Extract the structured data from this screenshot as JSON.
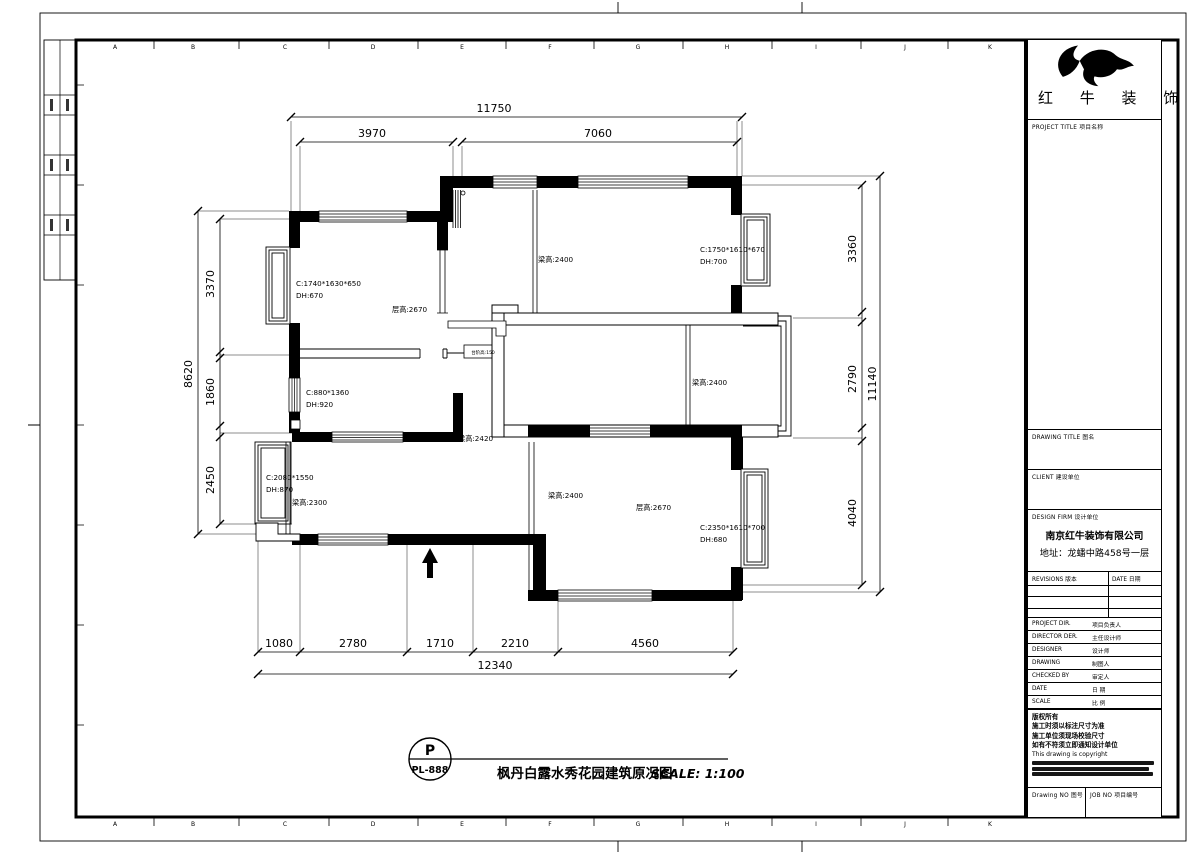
{
  "sheet": {
    "grid_letters": [
      "A",
      "B",
      "C",
      "D",
      "E",
      "F",
      "G",
      "H",
      "I",
      "J",
      "K"
    ],
    "grid_x": [
      115,
      193,
      285,
      373,
      462,
      550,
      638,
      727,
      816,
      905,
      990
    ],
    "accent_color": "#000000",
    "paper_color": "#ffffff"
  },
  "titleblock": {
    "brand": "红 牛 装 饰",
    "project_label": "PROJECT TITLE 项目名称",
    "drawing_label": "DRAWING TITLE 图名",
    "client_label": "CLIENT 建设单位",
    "firm_label": "DESIGN FIRM 设计单位",
    "firm_name": "南京红牛装饰有限公司",
    "firm_address": "地址：龙蟠中路458号一层",
    "revisions_label": "REVISIONS 版本",
    "rev_date_label": "DATE 日期",
    "rows": [
      {
        "en": "PROJECT DIR.",
        "cn": "项目负责人"
      },
      {
        "en": "DIRECTOR DER.",
        "cn": "主任设计师"
      },
      {
        "en": "DESIGNER",
        "cn": "设计师"
      },
      {
        "en": "DRAWING",
        "cn": "制图人"
      },
      {
        "en": "CHECKED BY",
        "cn": "审定人"
      },
      {
        "en": "DATE",
        "cn": "日 期"
      },
      {
        "en": "SCALE",
        "cn": "比 例"
      }
    ],
    "notes_cn": [
      "版权所有",
      "施工时须以标注尺寸为准",
      "施工单位须现场校验尺寸",
      "如有不符须立即通知设计单位"
    ],
    "notes_en": "This drawing is copyright",
    "drawing_no_label": "Drawing NO 图号",
    "job_no_label": "JOB NO 项目编号"
  },
  "stamp": {
    "letter": "P",
    "number": "PL-888",
    "title": "枫丹白露水秀花园建筑原况图",
    "scale": "SCALE: 1:100"
  },
  "plan_labels": [
    {
      "t": "C:1740*1630*650",
      "x": 296,
      "y": 286
    },
    {
      "t": "DH:670",
      "x": 296,
      "y": 298
    },
    {
      "t": "层高:2670",
      "x": 392,
      "y": 312
    },
    {
      "t": "梁高:2400",
      "x": 538,
      "y": 262
    },
    {
      "t": "C:1750*1610*670",
      "x": 700,
      "y": 252
    },
    {
      "t": "DH:700",
      "x": 700,
      "y": 264
    },
    {
      "t": "梁高:2400",
      "x": 692,
      "y": 385
    },
    {
      "t": "梁高:2420",
      "x": 458,
      "y": 441
    },
    {
      "t": "C:880*1360",
      "x": 306,
      "y": 395
    },
    {
      "t": "DH:920",
      "x": 306,
      "y": 407
    },
    {
      "t": "C:2080*1550",
      "x": 266,
      "y": 480
    },
    {
      "t": "DH:870",
      "x": 266,
      "y": 492
    },
    {
      "t": "梁高:2300",
      "x": 292,
      "y": 505
    },
    {
      "t": "梁高:2400",
      "x": 548,
      "y": 498
    },
    {
      "t": "层高:2670",
      "x": 636,
      "y": 510
    },
    {
      "t": "C:2350*1610*700",
      "x": 700,
      "y": 530
    },
    {
      "t": "DH:680",
      "x": 700,
      "y": 542
    },
    {
      "t": "台阶高:150",
      "x": 483,
      "y": 354,
      "s": 4.5,
      "a": "middle"
    }
  ],
  "dim_texts": [
    {
      "t": "11750",
      "x": 494,
      "y": 112
    },
    {
      "t": "3970",
      "x": 372,
      "y": 137
    },
    {
      "t": "7060",
      "x": 598,
      "y": 137
    },
    {
      "t": "8620",
      "x": 192,
      "y": 374,
      "r": -90
    },
    {
      "t": "3370",
      "x": 214,
      "y": 284,
      "r": -90
    },
    {
      "t": "1860",
      "x": 214,
      "y": 392,
      "r": -90
    },
    {
      "t": "2450",
      "x": 214,
      "y": 480,
      "r": -90
    },
    {
      "t": "3360",
      "x": 856,
      "y": 249,
      "r": -90
    },
    {
      "t": "2790",
      "x": 856,
      "y": 379,
      "r": -90
    },
    {
      "t": "4040",
      "x": 856,
      "y": 513,
      "r": -90
    },
    {
      "t": "11140",
      "x": 876,
      "y": 384,
      "r": -90
    },
    {
      "t": "1080",
      "x": 279,
      "y": 647
    },
    {
      "t": "2780",
      "x": 353,
      "y": 647
    },
    {
      "t": "1710",
      "x": 440,
      "y": 647
    },
    {
      "t": "2210",
      "x": 515,
      "y": 647
    },
    {
      "t": "4560",
      "x": 645,
      "y": 647
    },
    {
      "t": "12340",
      "x": 495,
      "y": 669
    }
  ]
}
